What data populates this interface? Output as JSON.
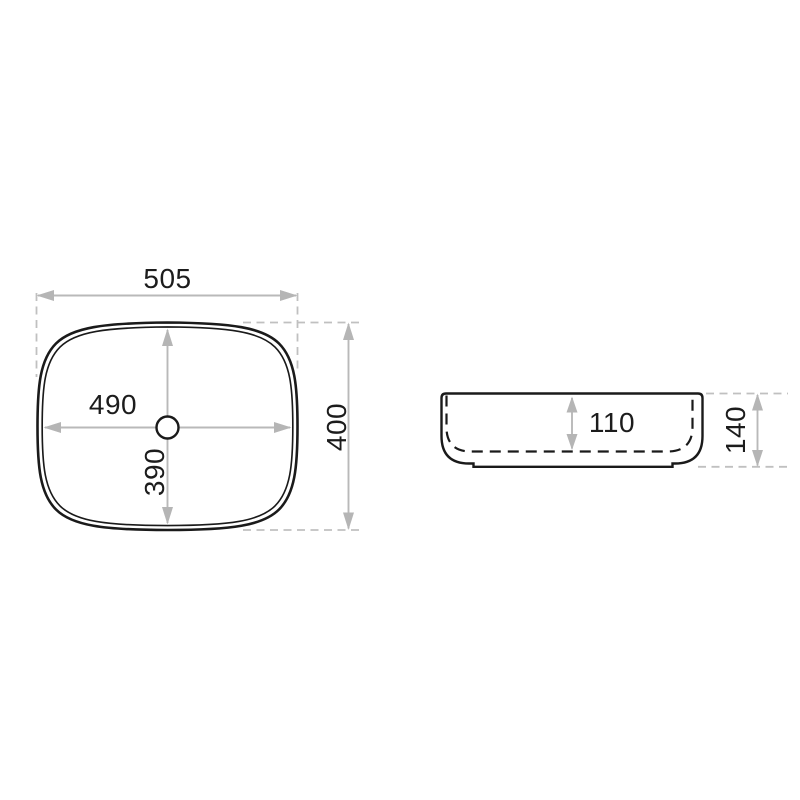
{
  "drawing": {
    "title": "countertop-washbasin-dimension-drawing",
    "colors": {
      "background": "#ffffff",
      "outline": "#1a1a1a",
      "dimension_lines": "#b9b9b9",
      "text": "#1c1c1c"
    },
    "top_view": {
      "outer_width_mm": "505",
      "outer_depth_mm": "400",
      "inner_width_mm": "490",
      "inner_depth_mm": "390"
    },
    "side_view": {
      "inner_height_mm": "110",
      "outer_height_mm": "140"
    }
  }
}
